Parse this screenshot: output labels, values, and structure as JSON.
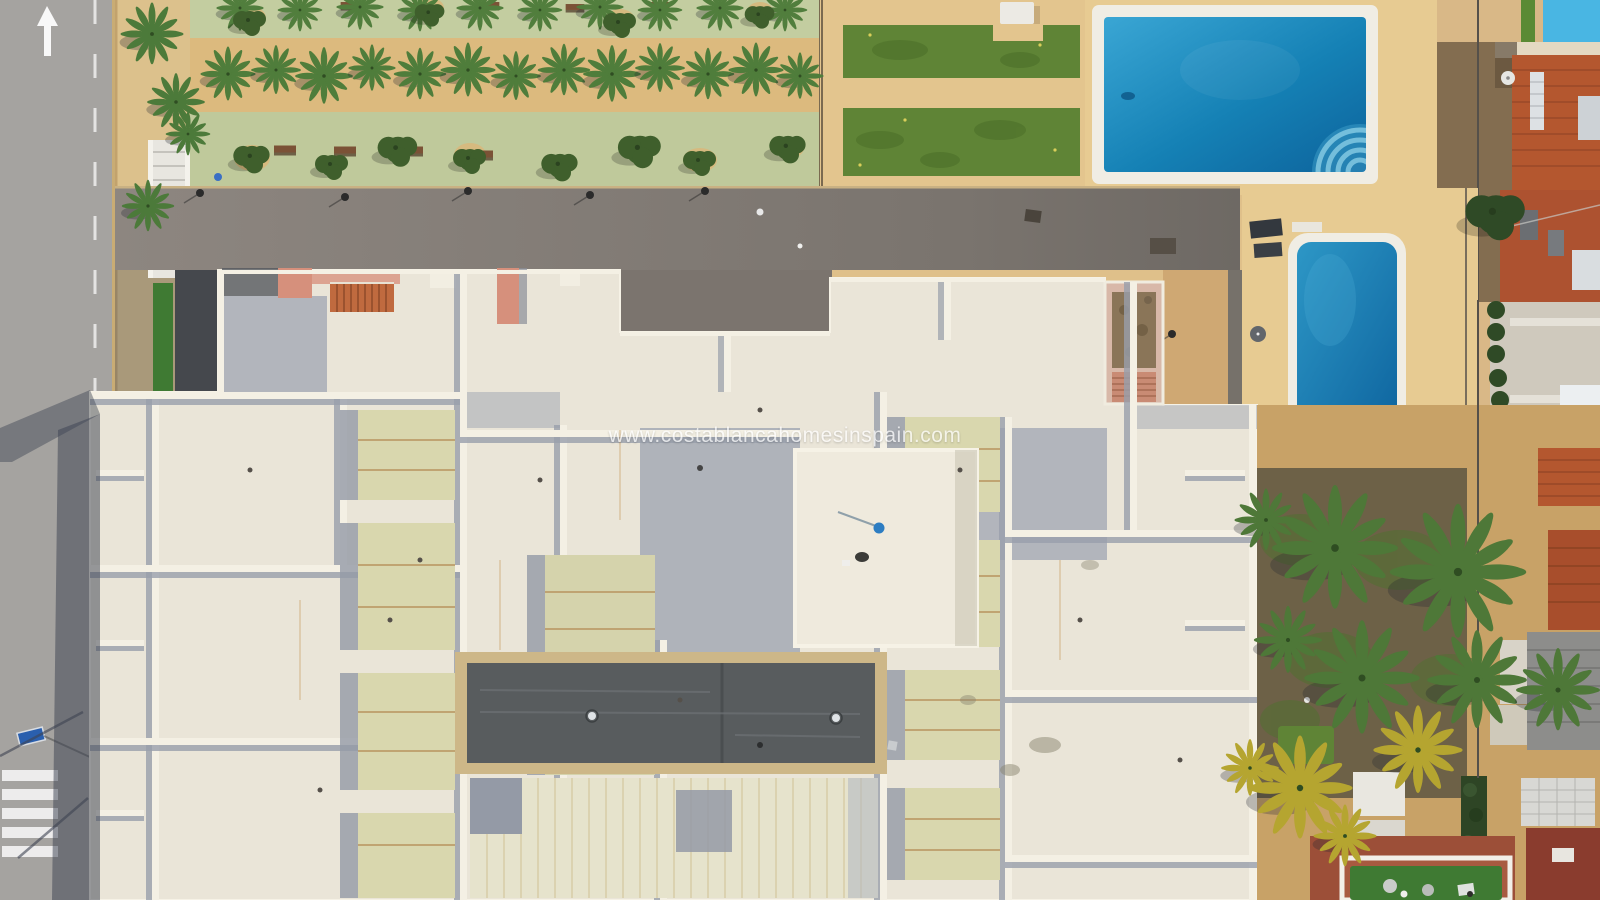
{
  "watermark": {
    "text": "www.costablancahomesinspain.com",
    "color": "#ffffff"
  },
  "road_marking": {
    "arrow_direction": "up"
  },
  "palette": {
    "road": "#a5a3a0",
    "asphalt": "#837c76",
    "sand": "#dfc08a",
    "deck": "#e7cb92",
    "rim": "#f0ede4",
    "roofWhite": "#eae5d8",
    "parapet": "#f4f0e4",
    "shadowBlue": "#3e4452",
    "skylight": "#d9d7ae",
    "palmGreen": "#4f7d3b",
    "palmYellow": "#b5a530",
    "lawn": "#5f8436",
    "parkGreen": "#c3cda0",
    "salmon": "#d6907c",
    "terracotta": "#b4572f",
    "darkRoof": "#585c5e",
    "stairs": "#c06a3f",
    "pink": "#d8b8a8",
    "redBuilding": "#8a3c2e",
    "turf": "#3f7a33",
    "signBlue": "#2a5fae",
    "poolWater": "#1581b5",
    "poolWaterLight": "#49b6e3"
  }
}
